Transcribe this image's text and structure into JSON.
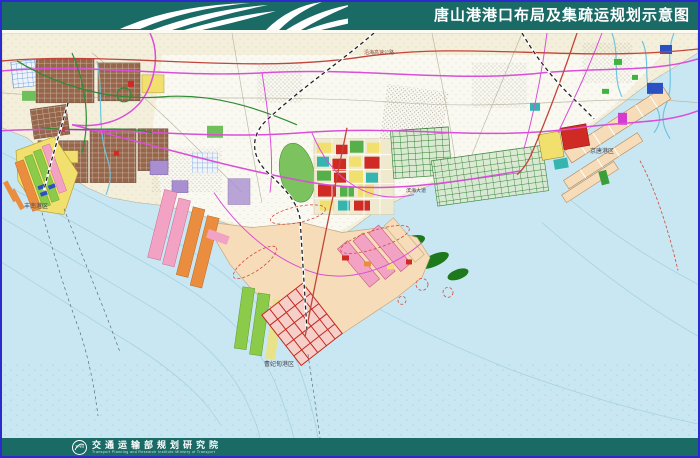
{
  "header": {
    "title": "唐山港港口布局及集疏运规划示意图"
  },
  "map": {
    "labels": {
      "fengnan": {
        "text": "丰南港区"
      },
      "caofeidian": {
        "text": "曹妃甸港区"
      },
      "jingtang": {
        "text": "京唐港区"
      },
      "coastal_expressway": {
        "text": "沿海高速公路"
      },
      "binhai_avenue": {
        "text": "滨海大道"
      }
    }
  },
  "footer": {
    "logo_text": "TPRI",
    "org_cn": "交通运输部规划研究院",
    "org_en": "Transport Planning and Research Institute Ministry of Transport"
  },
  "colors": {
    "border_blue": "#2a2ace",
    "header_bg": "#1a6a66",
    "sea": "#c9e7f2",
    "land_north": "#f4efdb",
    "land_white": "#fbfaf3",
    "road_magenta": "#d94fd9",
    "road_red": "#c1453a",
    "road_green": "#2f8b34",
    "brown": "#96664a",
    "yellow": "#f2e06e",
    "orange": "#eb8d3f",
    "pink": "#f2a3c3",
    "green_bright": "#8ccb4a",
    "green_dark": "#2f7d32",
    "red_block": "#cf2b24",
    "purple": "#a98fd1",
    "teal_block": "#35b5b0",
    "peach": "#f6dcb8",
    "blue_block": "#2b50c4"
  }
}
